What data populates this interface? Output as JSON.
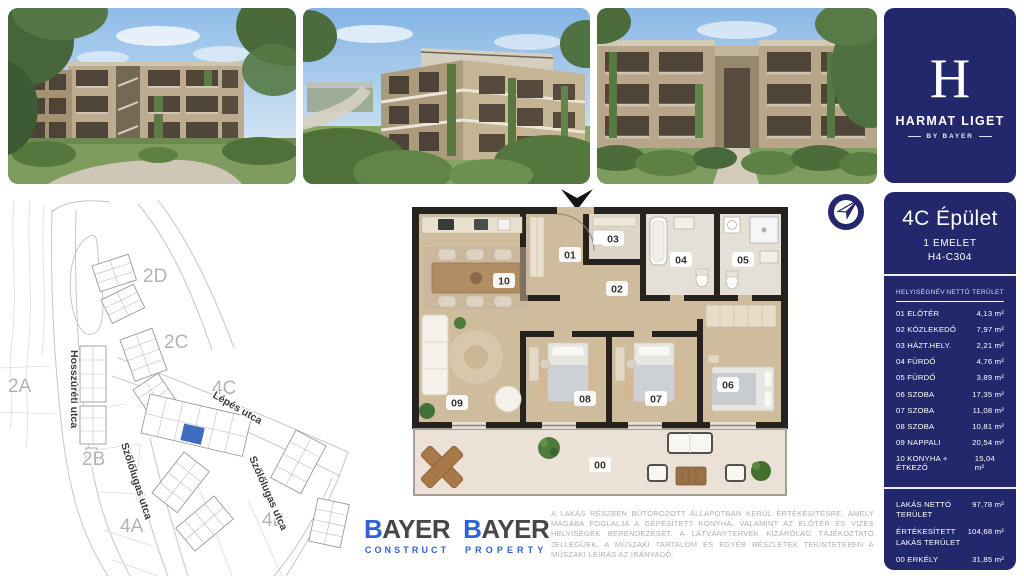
{
  "colors": {
    "navy": "#23276b",
    "unit-highlight": "#3f6bc0",
    "bayer-blue": "#2e63d6",
    "logo-dark": "#474747"
  },
  "brand": {
    "monogram": "H",
    "name": "HARMAT LIGET",
    "byline": "BY BAYER"
  },
  "unit_card": {
    "building": "4C Épület",
    "floor": "1 EMELET",
    "unit_code": "H4-C304",
    "table_header": {
      "name": "HELYISÉGNÉV",
      "area": "NETTÓ TERÜLET"
    },
    "rooms": [
      {
        "name": "01 ELŐTÉR",
        "area": "4,13 m²"
      },
      {
        "name": "02 KÖZLEKEDŐ",
        "area": "7,97 m²"
      },
      {
        "name": "03 HÁZT.HELY.",
        "area": "2,21 m²"
      },
      {
        "name": "04 FÜRDŐ",
        "area": "4,76 m²"
      },
      {
        "name": "05 FÜRDŐ",
        "area": "3,89 m²"
      },
      {
        "name": "06 SZOBA",
        "area": "17,35 m²"
      },
      {
        "name": "07 SZOBA",
        "area": "11,08 m²"
      },
      {
        "name": "08 SZOBA",
        "area": "10,81 m²"
      },
      {
        "name": "09 NAPPALI",
        "area": "20,54 m²"
      },
      {
        "name": "10 KONYHA + ÉTKEZŐ",
        "area": "15,04 m²"
      }
    ],
    "totals": [
      {
        "name": "LAKÁS NETTÓ TERÜLET",
        "area": "97,78 m²"
      },
      {
        "name": "ÉRTÉKESÍTETT LAKÁS TERÜLET",
        "area": "104,68 m²"
      },
      {
        "name": "00 ERKÉLY",
        "area": "31,85 m²"
      }
    ]
  },
  "site_map": {
    "streets": [
      "Hosszúréti utca",
      "Lépés utca",
      "Szőlőlugas utca",
      "Szőlőlugas utca"
    ],
    "blocks": [
      "2D",
      "2C",
      "2A",
      "4C",
      "2B",
      "4A",
      "4B"
    ]
  },
  "floor_plan": {
    "labels": [
      "10",
      "01",
      "03",
      "04",
      "05",
      "02",
      "09",
      "08",
      "07",
      "06",
      "00"
    ]
  },
  "logos": [
    {
      "initial": "B",
      "rest": "AYER",
      "division": "CONSTRUCT"
    },
    {
      "initial": "B",
      "rest": "AYER",
      "division": "PROPERTY"
    }
  ],
  "disclaimer": "A LAKÁS RÉSZBEN BÚTOROZOTT ÁLLAPOTBAN KERÜL ÉRTÉKESÍTÉSRE, AMELY MAGÁBA FOGLALJA A GÉPESÍTETT KONYHA, VALAMINT AZ ELŐTÉR ÉS VIZES HELYISÉGEK BERENDEZÉSÉT. A LÁTVÁNYTERVEK KIZÁRÓLAG TÁJÉKOZTATÓ JELLEGŰEK. A MŰSZAKI TARTALOM ÉS EGYÉB RÉSZLETEK TEKINTETÉBEN A MŰSZAKI LEÍRÁS AZ IRÁNYADÓ."
}
